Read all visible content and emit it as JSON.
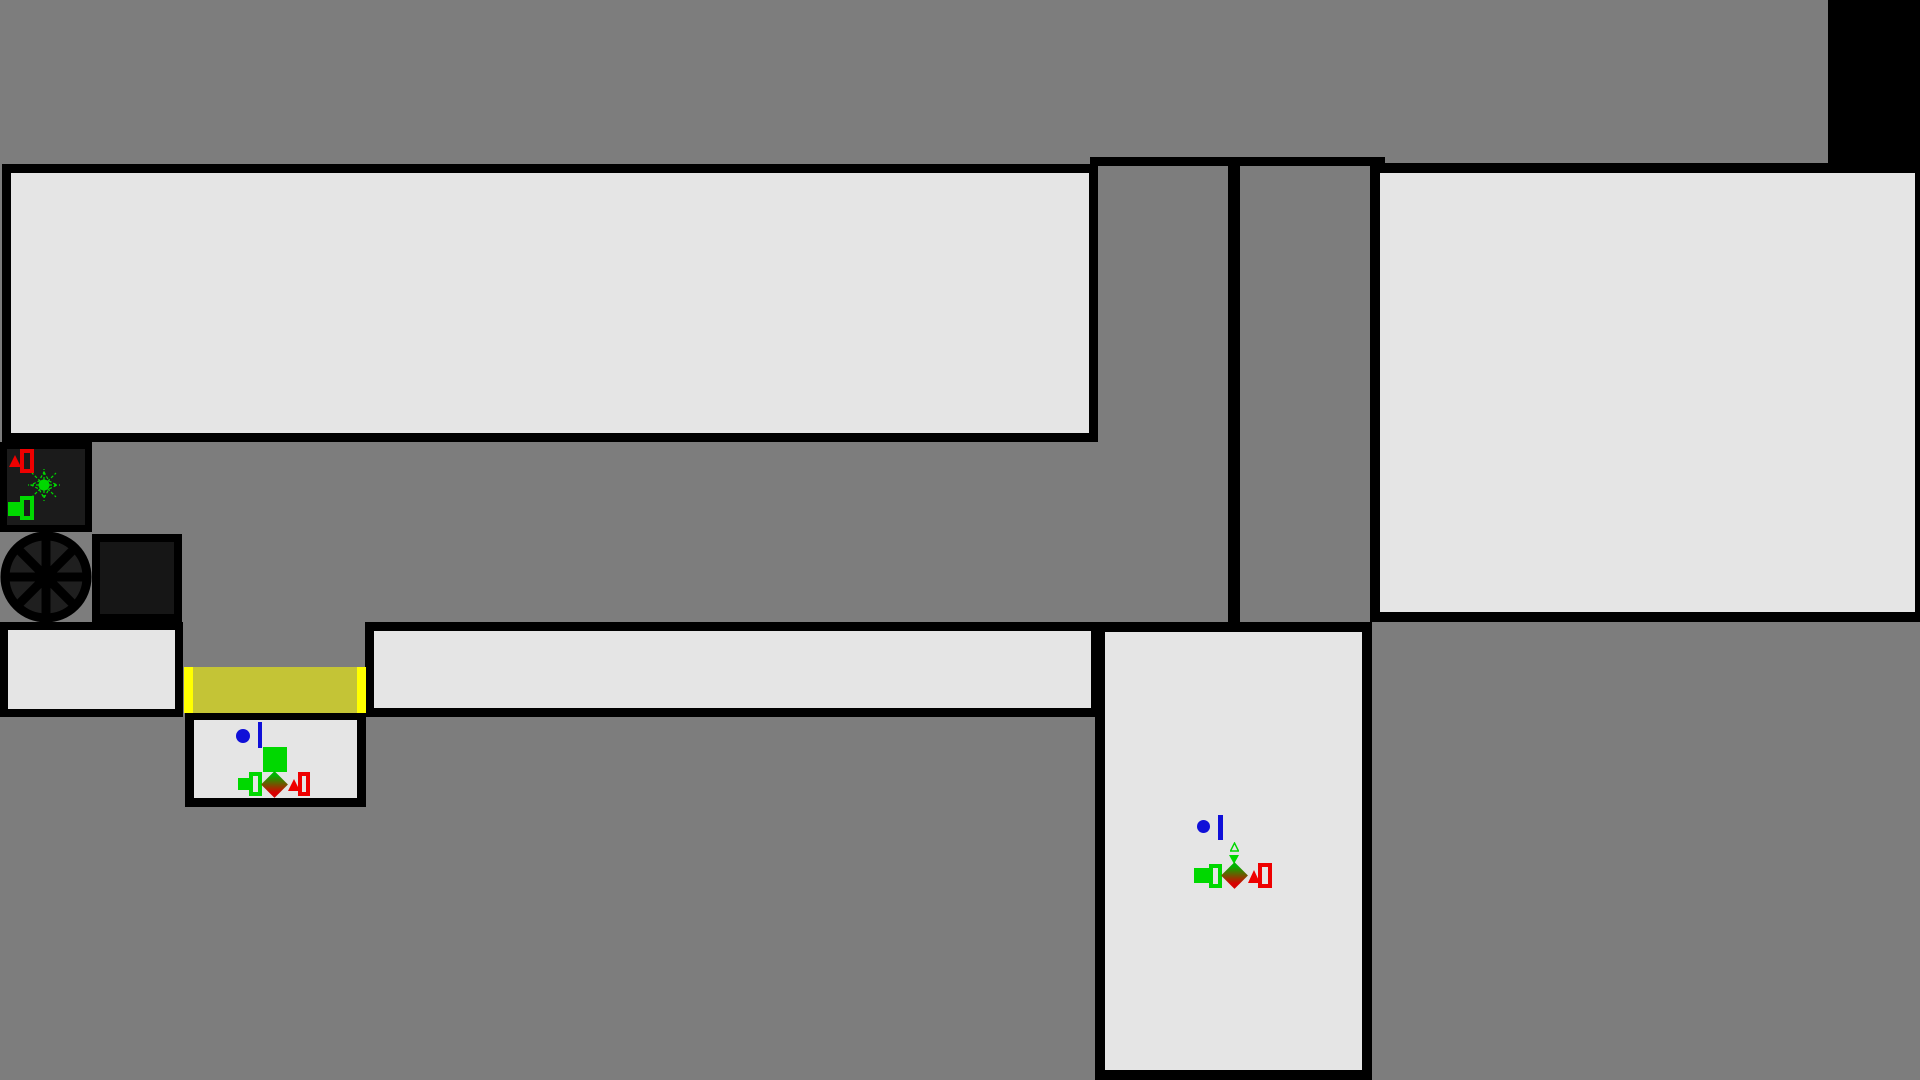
{
  "scene": {
    "kind": "top-down-game-map",
    "text_content": "none"
  },
  "colors": {
    "bg": "#7d7d7d",
    "floor": "#e5e5e5",
    "wall": "#000000",
    "darkfill": "#1b1b1b",
    "darkfill2": "#161616",
    "doorframe": "#ffff00",
    "doorbody": "#c4c436",
    "blue": "#1010d8",
    "green": "#00d800",
    "red": "#ee0000",
    "dgreen": "#00b400",
    "dred": "#d80000",
    "wheelfill": "#1f1f1f"
  },
  "rooms": [
    {
      "name": "room-top-left",
      "shape": "large rectangle, empty floor"
    },
    {
      "name": "room-top-right",
      "shape": "large rectangle, empty floor, touches right edge"
    },
    {
      "name": "room-small-left",
      "shape": "small rectangle, empty floor, touches left edge"
    },
    {
      "name": "corridor-room",
      "shape": "long horizontal corridor, empty floor"
    },
    {
      "name": "room-door-lower",
      "shape": "small rectangle under yellow door, holds entity cluster"
    },
    {
      "name": "room-bottom-middle",
      "shape": "tall rectangle reaching bottom edge, holds entity cluster"
    }
  ],
  "objects": [
    {
      "name": "machine-box",
      "icons": [
        "red-triangle",
        "red-rect-outline",
        "green-starburst",
        "green-square",
        "green-rect-outline"
      ]
    },
    {
      "name": "spoked-wheel",
      "description": "black 8-spoke wheel"
    },
    {
      "name": "dark-crate",
      "description": "dark square crate with black border"
    },
    {
      "name": "yellow-door",
      "description": "horizontal door, bright yellow frames, olive body"
    },
    {
      "name": "black-corner-block",
      "description": "solid black rectangle at top-right edge"
    },
    {
      "name": "top-wall-bar",
      "description": "horizontal black wall segment"
    },
    {
      "name": "corridor-divider-wall",
      "description": "vertical black wall segment"
    }
  ],
  "entity_cluster_room1": [
    "blue-dot",
    "blue-bar",
    "green-square-large",
    "green-square-small",
    "green-rect-outline",
    "gradient-diamond",
    "red-triangle",
    "red-rect-outline"
  ],
  "entity_cluster_room2": [
    "blue-dot",
    "blue-bar",
    "green-triangle-outline",
    "green-triangle-down",
    "green-square",
    "green-rect-outline",
    "gradient-diamond",
    "red-triangle",
    "red-rect-outline"
  ]
}
